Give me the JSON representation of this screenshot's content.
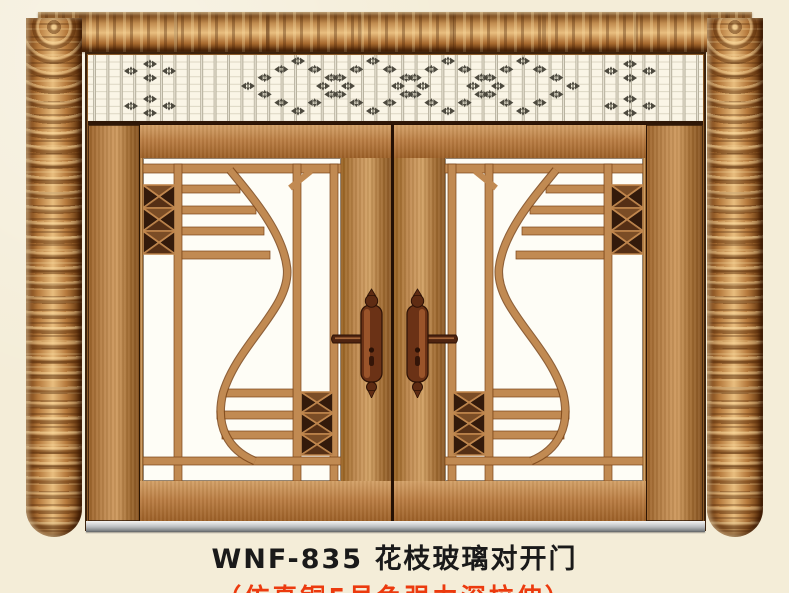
{
  "product": {
    "model": "WNF-835",
    "name": "花枝玻璃对开门",
    "finish_note": "仿真铜5号色强力深拉伸"
  },
  "caption": {
    "line1": "WNF-835 花枝玻璃对开门",
    "line2": "（仿真铜5号色强力深拉伸）"
  },
  "colors": {
    "background": "#f4edd8",
    "copper_light": "#e8bd7e",
    "copper_mid": "#b97b42",
    "copper_dark": "#6e3b10",
    "grille_bar": "#c18a52",
    "grille_edge": "#7a4418",
    "glass_white": "#fefdf6",
    "xblock_dark": "#331a0b",
    "lattice_bar": "#b9b3a0",
    "lattice_line": "#ddd7c4",
    "motif_dark": "#4d4a3f",
    "threshold_silver": "#b7babc",
    "caption_text": "#1a1a1a",
    "caption_accent": "#ec3a0e"
  }
}
